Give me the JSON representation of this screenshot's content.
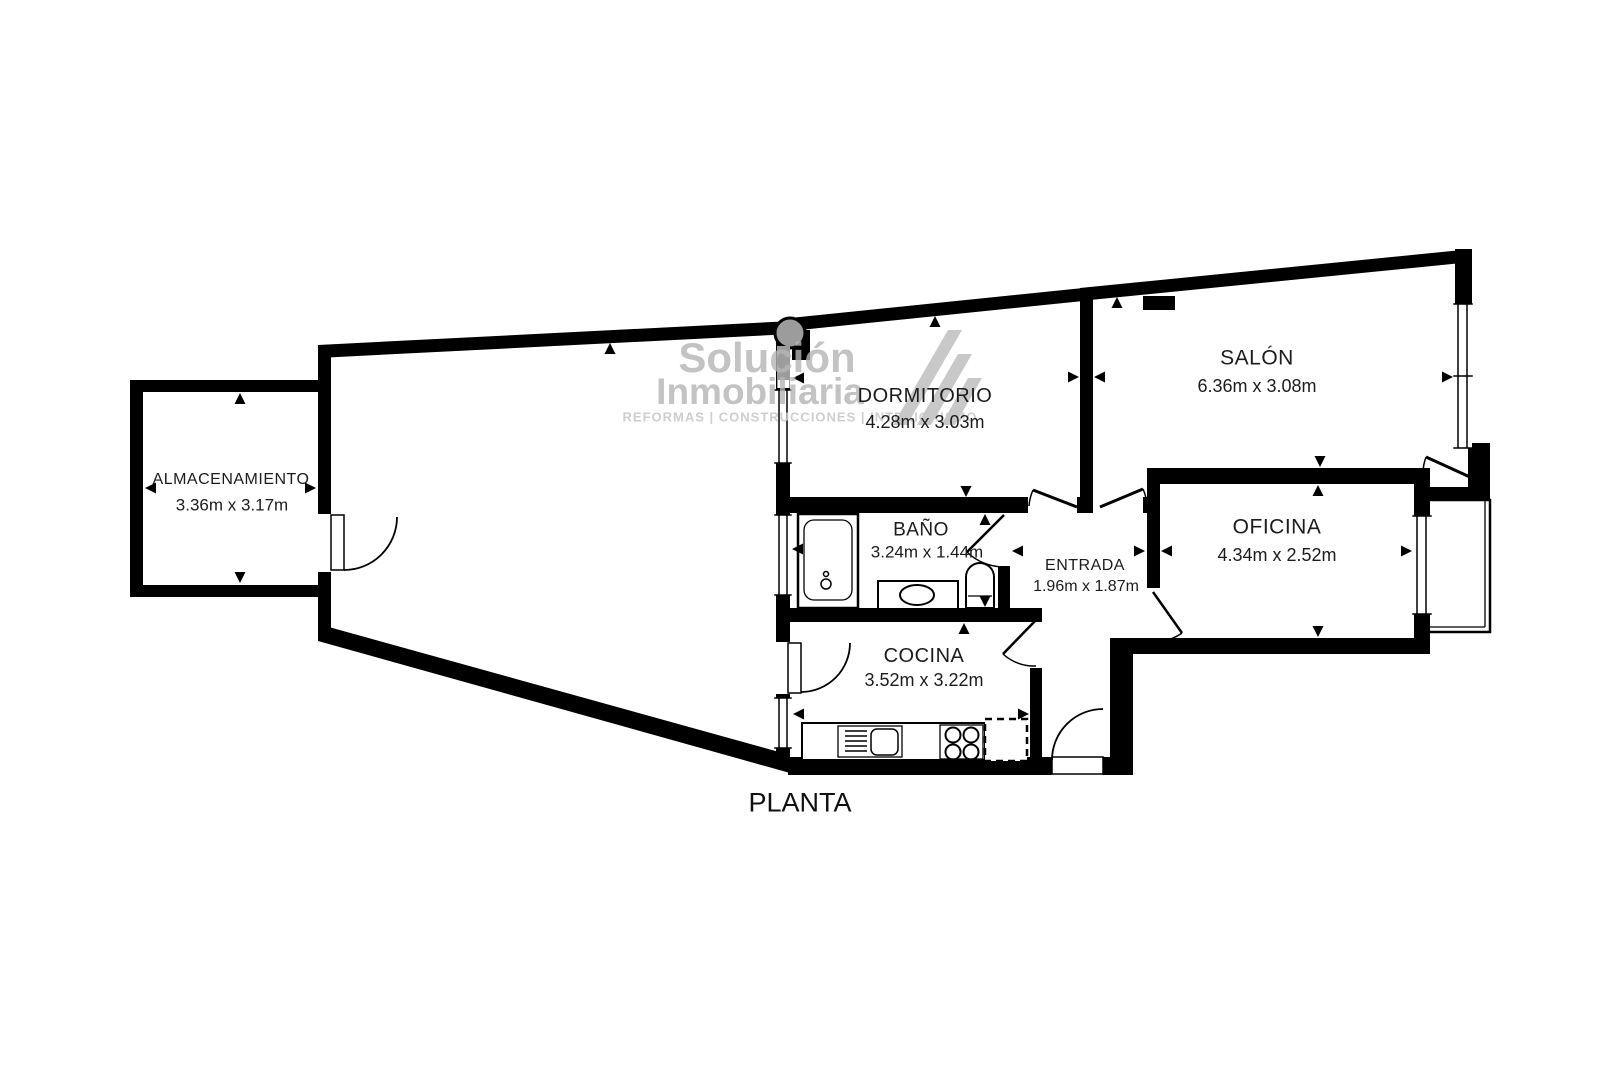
{
  "plan_title": "PLANTA",
  "watermark": {
    "brand_line1": "Solución",
    "brand_line2": "Inmobiliaria",
    "tagline": "REFORMAS | CONSTRUCCIONES | INTERIORISMO"
  },
  "rooms": {
    "almacenamiento": {
      "name": "ALMACENAMIENTO",
      "dimensions": "3.36m x 3.17m"
    },
    "dormitorio": {
      "name": "DORMITORIO",
      "dimensions": "4.28m x 3.03m"
    },
    "salon": {
      "name": "SALÓN",
      "dimensions": "6.36m x 3.08m"
    },
    "bano": {
      "name": "BAÑO",
      "dimensions": "3.24m x 1.44m"
    },
    "entrada": {
      "name": "ENTRADA",
      "dimensions": "1.96m x 1.87m"
    },
    "oficina": {
      "name": "OFICINA",
      "dimensions": "4.34m x 2.52m"
    },
    "cocina": {
      "name": "COCINA",
      "dimensions": "3.52m x 3.22m"
    }
  },
  "colors": {
    "wall": "#000000",
    "watermark_text": "#b5b5b5",
    "watermark_tagline": "#c9c9c9",
    "column_gray": "#9c9c9c",
    "label_text": "#1c1c1c"
  }
}
